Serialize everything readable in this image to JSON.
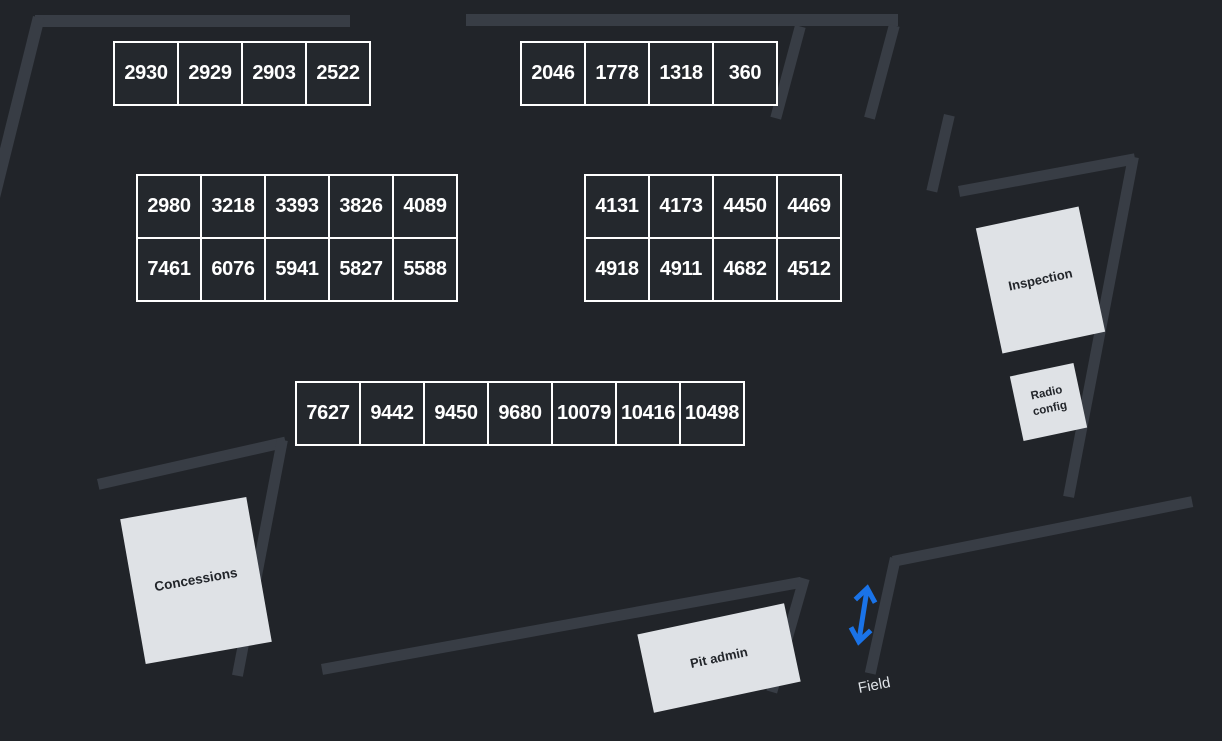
{
  "map": {
    "background_color": "#212429",
    "wall_color": "#383d45",
    "pit_box_fill": "#24282d",
    "pit_box_border": "#ffffff",
    "pit_box_text_color": "#ffffff",
    "area_box_fill": "#dfe2e6",
    "area_box_text_color": "#22252a",
    "arrow_color": "#1a73e8"
  },
  "pit_groups": [
    {
      "id": "top-left",
      "rows": [
        [
          "2930",
          "2929",
          "2903",
          "2522"
        ]
      ]
    },
    {
      "id": "top-center",
      "rows": [
        [
          "2046",
          "1778",
          "1318",
          "360"
        ]
      ]
    },
    {
      "id": "center-left",
      "rows": [
        [
          "2980",
          "3218",
          "3393",
          "3826",
          "4089"
        ],
        [
          "7461",
          "6076",
          "5941",
          "5827",
          "5588"
        ]
      ]
    },
    {
      "id": "center-right",
      "rows": [
        [
          "4131",
          "4173",
          "4450",
          "4469"
        ],
        [
          "4918",
          "4911",
          "4682",
          "4512"
        ]
      ]
    },
    {
      "id": "bottom-center",
      "rows": [
        [
          "7627",
          "9442",
          "9450",
          "9680",
          "10079",
          "10416",
          "10498"
        ]
      ]
    }
  ],
  "areas": {
    "inspection": {
      "label": "Inspection"
    },
    "radio_config": {
      "label": "Radio config"
    },
    "concessions": {
      "label": "Concessions"
    },
    "pit_admin": {
      "label": "Pit admin"
    }
  },
  "field": {
    "label": "Field"
  }
}
